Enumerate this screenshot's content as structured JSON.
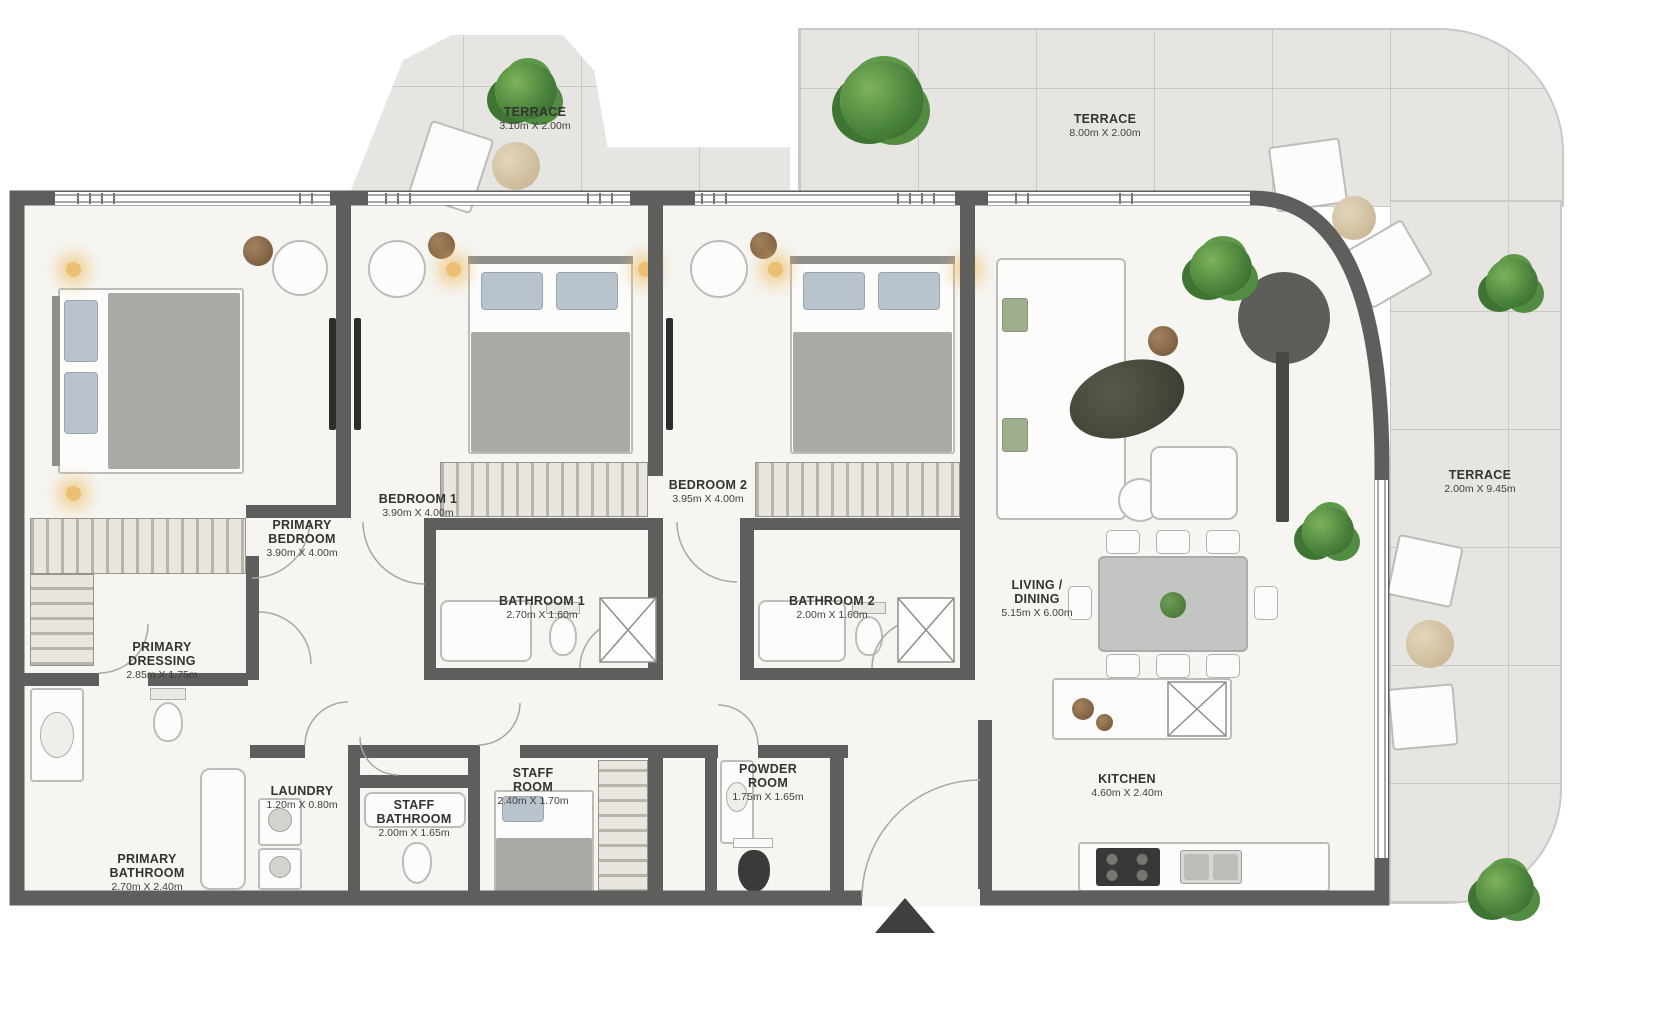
{
  "rooms": {
    "terrace_top_left": {
      "name": "TERRACE",
      "dims": "3.10m X 2.00m"
    },
    "terrace_top_right": {
      "name": "TERRACE",
      "dims": "8.00m X 2.00m"
    },
    "terrace_right": {
      "name": "TERRACE",
      "dims": "2.00m X 9.45m"
    },
    "primary_bedroom": {
      "name": "PRIMARY BEDROOM",
      "dims": "3.90m X 4.00m"
    },
    "bedroom_1": {
      "name": "BEDROOM 1",
      "dims": "3.90m X 4.00m"
    },
    "bedroom_2": {
      "name": "BEDROOM 2",
      "dims": "3.95m X 4.00m"
    },
    "bathroom_1": {
      "name": "BATHROOM 1",
      "dims": "2.70m X 1.60m"
    },
    "bathroom_2": {
      "name": "BATHROOM 2",
      "dims": "2.00m X 1.60m"
    },
    "primary_dressing": {
      "name": "PRIMARY DRESSING",
      "dims": "2.85m X 1.75m"
    },
    "primary_bathroom": {
      "name": "PRIMARY BATHROOM",
      "dims": "2.70m X 2.40m"
    },
    "laundry": {
      "name": "LAUNDRY",
      "dims": "1.20m X 0.80m"
    },
    "staff_bathroom": {
      "name": "STAFF BATHROOM",
      "dims": "2.00m X 1.65m"
    },
    "staff_room": {
      "name": "STAFF ROOM",
      "dims": "2.40m X 1.70m"
    },
    "powder_room": {
      "name": "POWDER ROOM",
      "dims": "1.75m X 1.65m"
    },
    "living_dining": {
      "name": "LIVING / DINING",
      "dims": "5.15m X 6.00m"
    },
    "kitchen": {
      "name": "KITCHEN",
      "dims": "4.60m X 2.40m"
    }
  },
  "colors": {
    "wall": "#5e5e5c",
    "terrace_floor": "#e6e5e2",
    "interior_floor": "#f6f5f2",
    "plant_green": "#47803a",
    "lamp_glow": "#ecbf72",
    "label_text": "#34332f"
  }
}
